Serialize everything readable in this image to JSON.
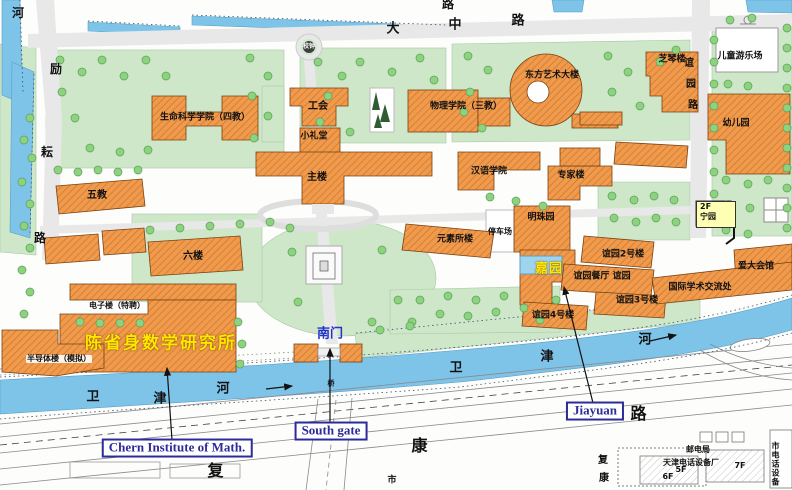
{
  "colors": {
    "building_fill": "#ef9a4d",
    "building_hatch": "#cf7526",
    "water": "#7ec3e8",
    "green": "#cfe7c9",
    "tree": "#8ed17f",
    "road_gray": "#e8e8e8",
    "highlight_yellow": "#ffe800",
    "annotation_blue": "#2b2b99",
    "ningyuan_bg": "#ffffb4"
  },
  "buildings": {
    "life_science": "生命科学学院（四教）",
    "labor_union": "工会",
    "small_auditorium": "小礼堂",
    "physics": "物理学院（三教）",
    "oriental_art": "东方艺术大楼",
    "zhiqin": "芝琴楼",
    "kindergarten": "幼儿园",
    "no5_teaching": "五教",
    "main_building": "主楼",
    "hanyu_college": "汉语学院",
    "experts_bldg": "专家楼",
    "no6_bldg": "六楼",
    "yuansuo": "元素所楼",
    "mingzhu": "明珠园",
    "yiyuan2": "谊园2号楼",
    "yiyuan_canteen": "谊园餐厅 谊园",
    "yiyuan3": "谊园3号楼",
    "yiyuan4": "谊园4号楼",
    "aida_hall": "爱大会馆",
    "intl_academic": "国际学术交流处",
    "electronics": "电子楼（特聘）",
    "semiconductor": "半导体楼（模拟）",
    "ningyuan_floor": "2F",
    "ningyuan": "宁园",
    "chern_institute": "陈省身数学研究所",
    "jiayuan": "嘉园"
  },
  "places": {
    "playground": "儿童游乐场",
    "parking": "停车场",
    "school_bell": "校钟",
    "south_gate": "南门",
    "bridge": "桥"
  },
  "roads": {
    "dazhong": [
      "大",
      "中",
      "路"
    ],
    "top_lu": "路",
    "left_road": [
      "励",
      "耘",
      "路"
    ],
    "left_river": "河",
    "yiyuan_road": [
      "谊",
      "园",
      "路"
    ],
    "weijin_west": [
      "卫",
      "津",
      "河"
    ],
    "weijin_east": [
      "卫",
      "津",
      "河"
    ],
    "fukang": [
      "复",
      "康",
      "路"
    ],
    "fukang_small": [
      "复",
      "康"
    ],
    "shi": "市"
  },
  "annotations": {
    "chern_en": "Chern Institute of Math.",
    "south_gate_en": "South gate",
    "jiayuan_en": "Jiayuan"
  },
  "offsite": {
    "post_office": "邮电局",
    "telephone_factory": "天津电话设备厂",
    "floor_6f": "6F",
    "floor_5f": "5F",
    "floor_7f": "7F",
    "right_vertical": "市电话设备"
  }
}
